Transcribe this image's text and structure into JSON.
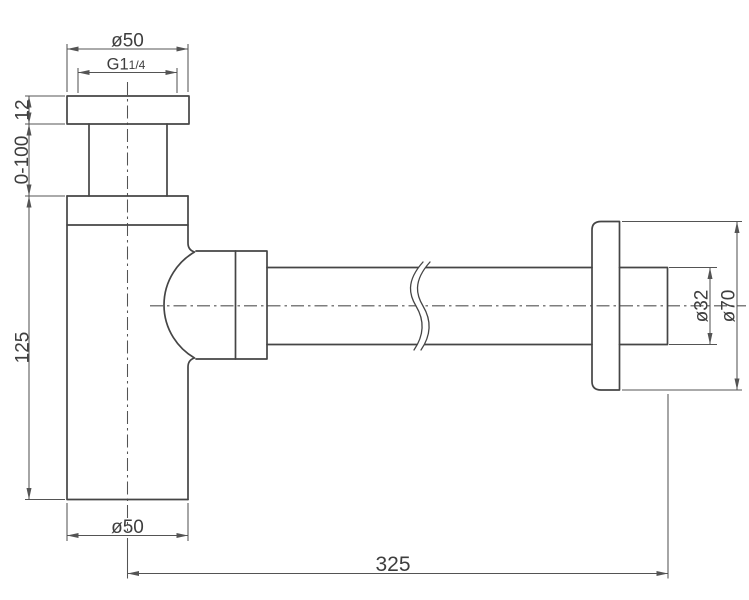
{
  "dims": {
    "top_diameter": "ø50",
    "thread_main": "G1",
    "thread_fraction": "1/4",
    "flange_thickness": "12",
    "adjustment_range": "0-100",
    "body_height": "125",
    "bottom_diameter": "ø50",
    "pipe_length": "325",
    "pipe_diameter": "ø32",
    "wall_flange_diameter": "ø70"
  },
  "colors": {
    "outline": "#454545",
    "dimension": "#545454",
    "text": "#3e3e3e",
    "background": "#ffffff"
  }
}
